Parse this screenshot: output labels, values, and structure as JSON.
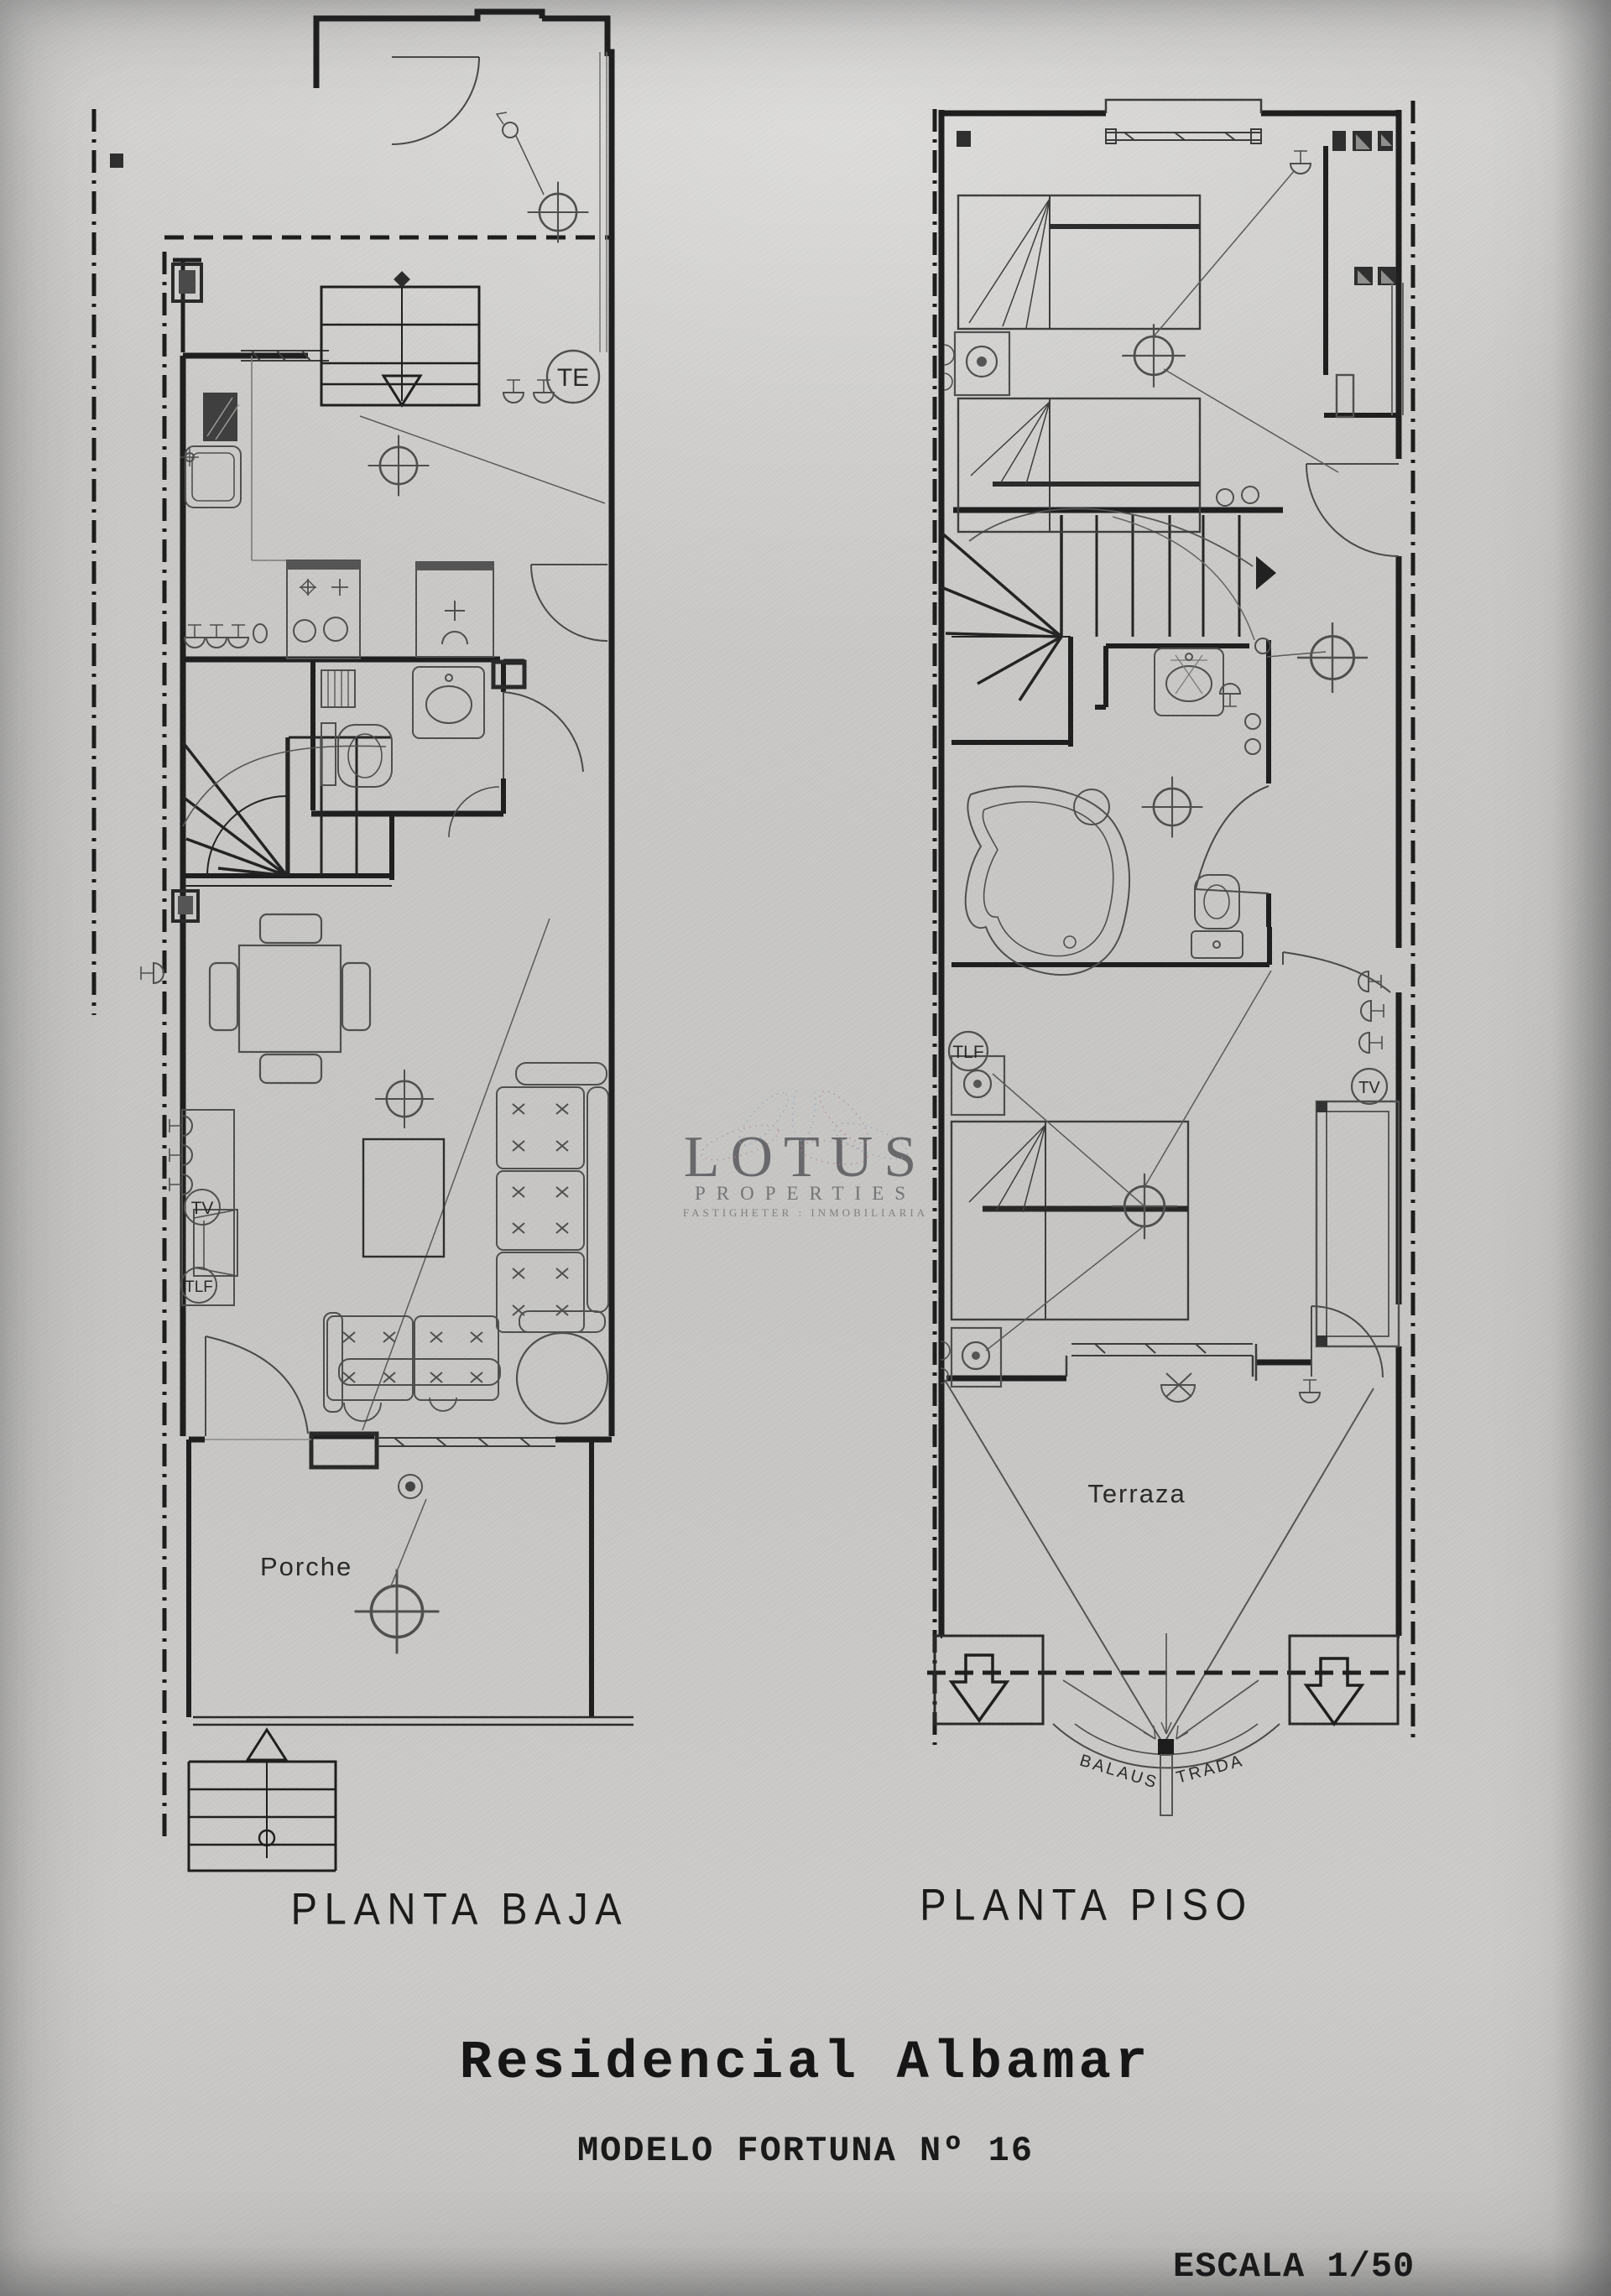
{
  "watermark": {
    "brand": "LOTUS",
    "line2": "PROPERTIES",
    "line3": "FASTIGHETER : INMOBILIARIA",
    "petal_red": "#b5868e",
    "petal_blue": "#8fa3ba"
  },
  "plans": {
    "left": {
      "title": "PLANTA BAJA",
      "porch_label": "Porche",
      "te": "TE",
      "tv": "TV",
      "tlf": "TLF"
    },
    "right": {
      "title": "PLANTA PISO",
      "terrace_label": "Terraza",
      "tlf": "TLF",
      "tv": "TV",
      "balustrade_left": "BALAUS",
      "balustrade_right": "TRADA"
    }
  },
  "footer": {
    "project": "Residencial Albamar",
    "model": "MODELO FORTUNA Nº 16",
    "scale": "ESCALA 1/50"
  },
  "colors": {
    "paper": "#cbcac8",
    "ink": "#1f1f1f",
    "furniture": "#4f4f4f",
    "light_line": "#6e6e6e"
  }
}
